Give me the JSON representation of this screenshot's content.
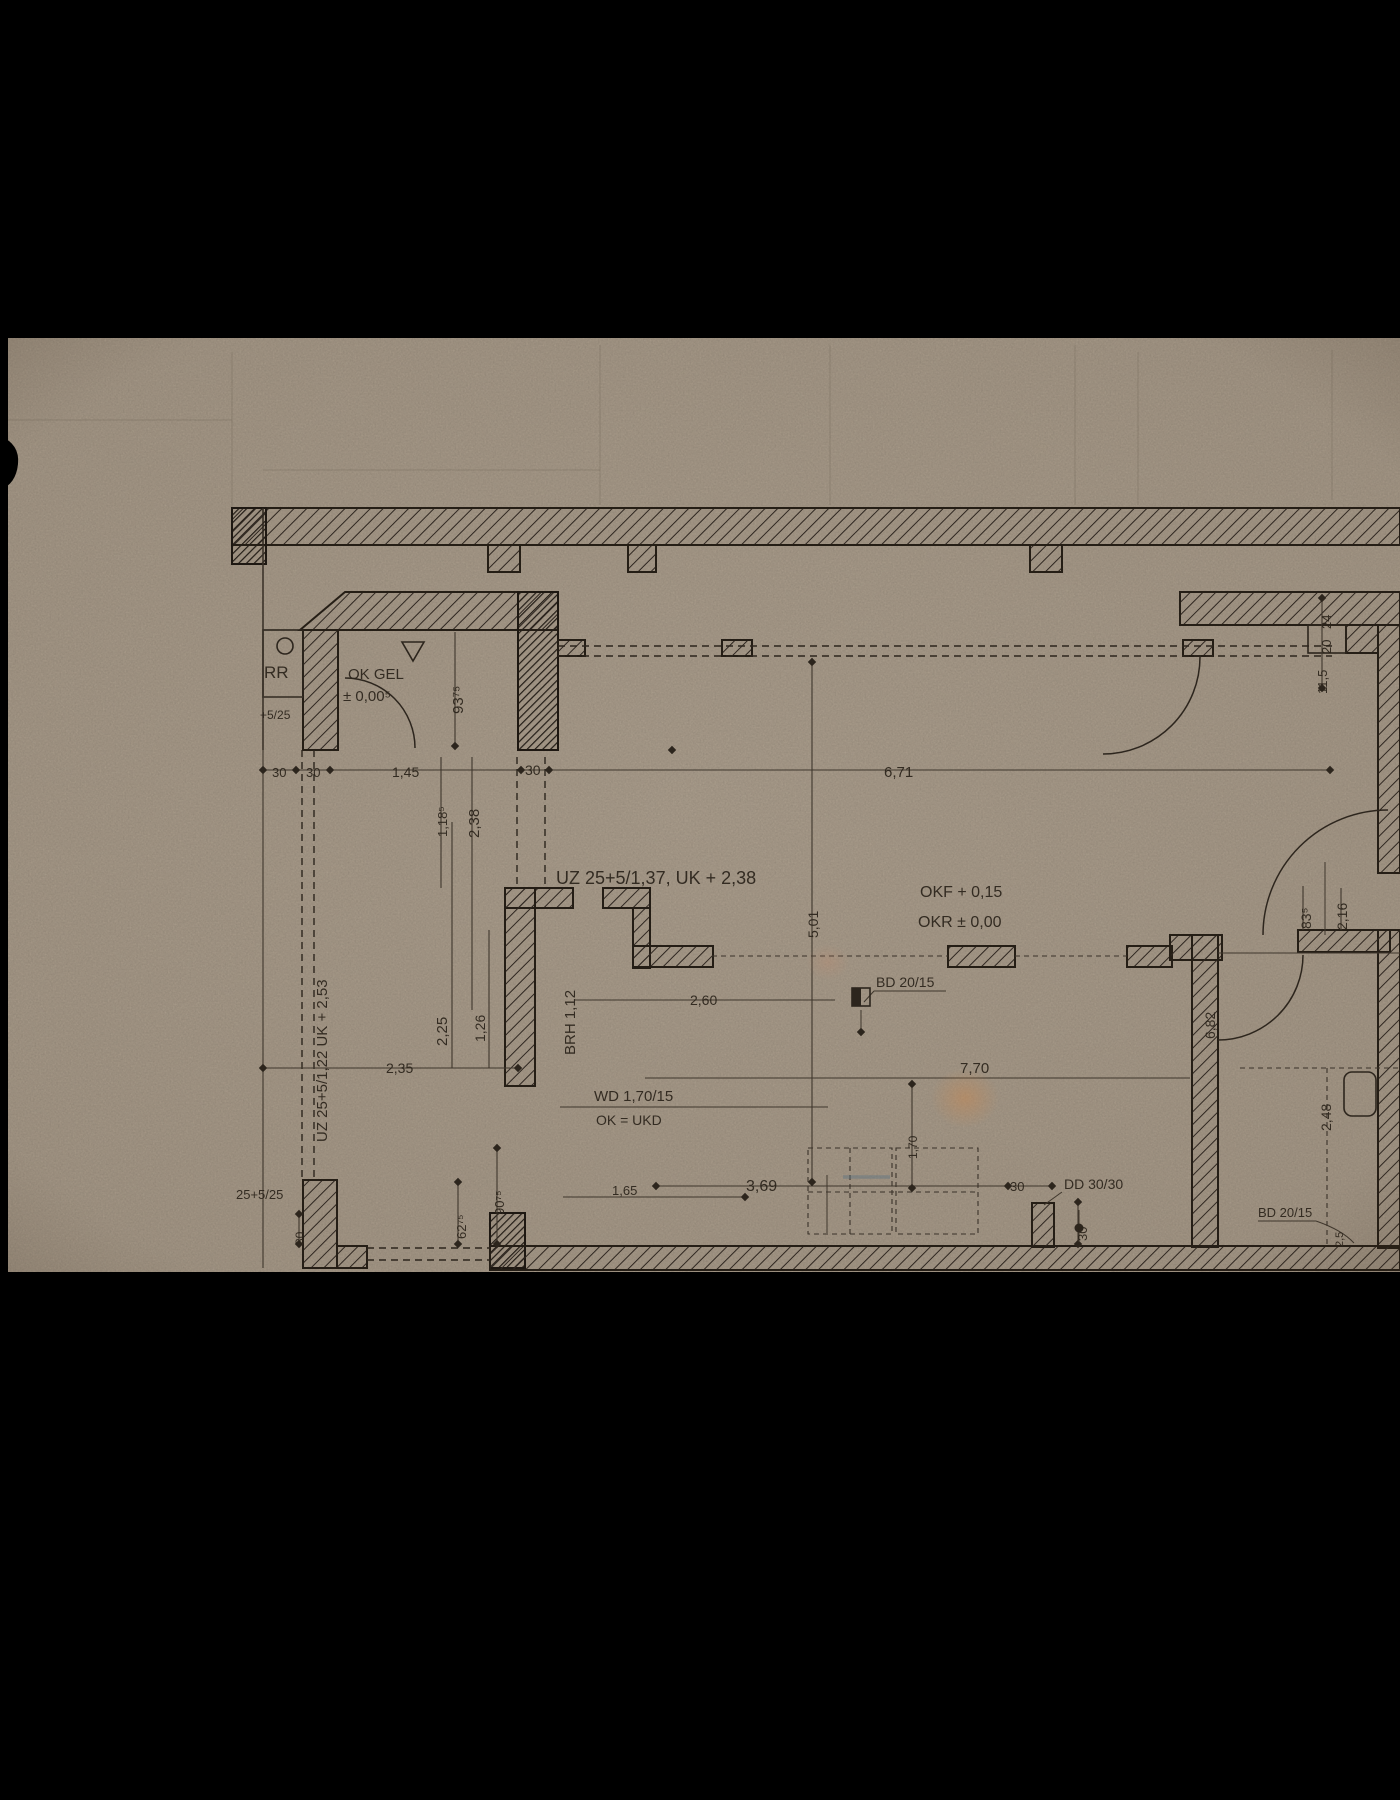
{
  "colors": {
    "letterbox": "#000000",
    "paper": "#b4a694",
    "ink": "#261f18",
    "pencil_guide": "#6b5f52",
    "stain_orange": "#cf8a4f",
    "crayon_blue": "#5d7684"
  },
  "labels": [
    {
      "name": "label-rr",
      "text": "RR",
      "x": 264,
      "y": 678,
      "fs": 17
    },
    {
      "name": "label-ok-gel",
      "text": "OK GEL",
      "x": 348,
      "y": 679,
      "fs": 15
    },
    {
      "name": "label-ok-gel-level",
      "text": "± 0,00⁵",
      "x": 343,
      "y": 701,
      "fs": 15
    },
    {
      "name": "dim-93-75",
      "text": "93⁷⁵",
      "x": 463,
      "y": 714,
      "rot": -90,
      "fs": 15
    },
    {
      "name": "note-5-25",
      "text": "+5/25",
      "x": 260,
      "y": 719,
      "fs": 12
    },
    {
      "name": "dim-30-left-a",
      "text": "30",
      "x": 272,
      "y": 777,
      "fs": 13
    },
    {
      "name": "dim-30-left-b",
      "text": "30",
      "x": 306,
      "y": 777,
      "fs": 13
    },
    {
      "name": "dim-1-45",
      "text": "1,45",
      "x": 392,
      "y": 777,
      "fs": 14
    },
    {
      "name": "dim-30-pier",
      "text": "30",
      "x": 525,
      "y": 775,
      "fs": 14
    },
    {
      "name": "dim-6-71",
      "text": "6,71",
      "x": 884,
      "y": 777,
      "fs": 15
    },
    {
      "name": "dim-1-18-5",
      "text": "1,18⁵",
      "x": 447,
      "y": 837,
      "rot": -90,
      "fs": 13
    },
    {
      "name": "dim-2-38",
      "text": "2,38",
      "x": 479,
      "y": 838,
      "rot": -90,
      "fs": 15
    },
    {
      "name": "dim-24",
      "text": "24",
      "x": 1331,
      "y": 629,
      "rot": -90,
      "fs": 13
    },
    {
      "name": "dim-20",
      "text": "20",
      "x": 1331,
      "y": 654,
      "rot": -90,
      "fs": 13
    },
    {
      "name": "dim-11-5",
      "text": "11,5",
      "x": 1327,
      "y": 694,
      "rot": -90,
      "fs": 13
    },
    {
      "name": "label-beam-uz-137",
      "text": "UZ 25+5/1,37, UK + 2,38",
      "x": 556,
      "y": 884,
      "fs": 18
    },
    {
      "name": "label-okf",
      "text": "OKF + 0,15",
      "x": 920,
      "y": 897,
      "fs": 16
    },
    {
      "name": "label-okr",
      "text": "OKR ± 0,00",
      "x": 918,
      "y": 927,
      "fs": 16
    },
    {
      "name": "dim-83-5",
      "text": "83⁵",
      "x": 1311,
      "y": 929,
      "rot": -90,
      "fs": 14
    },
    {
      "name": "dim-2-16",
      "text": "2,16",
      "x": 1347,
      "y": 930,
      "rot": -90,
      "fs": 14
    },
    {
      "name": "dim-5-01",
      "text": "5,01",
      "x": 818,
      "y": 938,
      "rot": -90,
      "fs": 14
    },
    {
      "name": "dim-2-60",
      "text": "2,60",
      "x": 690,
      "y": 1005,
      "fs": 14
    },
    {
      "name": "label-bd-20-15-mid",
      "text": "BD 20/15",
      "x": 876,
      "y": 987,
      "fs": 14
    },
    {
      "name": "dim-brh-1-12",
      "text": "BRH 1,12",
      "x": 575,
      "y": 1055,
      "rot": -90,
      "fs": 15
    },
    {
      "name": "dim-2-25",
      "text": "2,25",
      "x": 447,
      "y": 1046,
      "rot": -90,
      "fs": 15
    },
    {
      "name": "dim-1-26",
      "text": "1,26",
      "x": 485,
      "y": 1042,
      "rot": -90,
      "fs": 14
    },
    {
      "name": "dim-2-35",
      "text": "2,35",
      "x": 386,
      "y": 1073,
      "fs": 14
    },
    {
      "name": "label-beam-uz-122",
      "text": "UZ 25+5/1,22  UK + 2,53",
      "x": 327,
      "y": 1142,
      "rot": -90,
      "fs": 15
    },
    {
      "name": "label-wd-1-70-15",
      "text": "WD 1,70/15",
      "x": 594,
      "y": 1101,
      "fs": 15
    },
    {
      "name": "label-ok-ukd",
      "text": "OK = UKD",
      "x": 596,
      "y": 1125,
      "fs": 14
    },
    {
      "name": "dim-7-70",
      "text": "7,70",
      "x": 960,
      "y": 1073,
      "fs": 15
    },
    {
      "name": "dim-1-70",
      "text": "1,70",
      "x": 917,
      "y": 1159,
      "rot": -90,
      "fs": 12
    },
    {
      "name": "dim-3-69",
      "text": "3,69",
      "x": 746,
      "y": 1191,
      "fs": 16
    },
    {
      "name": "dim-1-65",
      "text": "1,65",
      "x": 612,
      "y": 1195,
      "fs": 13
    },
    {
      "name": "dim-30-right",
      "text": "30",
      "x": 1010,
      "y": 1191,
      "fs": 13
    },
    {
      "name": "label-dd-30-30",
      "text": "DD 30/30",
      "x": 1064,
      "y": 1189,
      "fs": 14
    },
    {
      "name": "dim-30-bottom",
      "text": "30",
      "x": 1087,
      "y": 1241,
      "rot": -90,
      "fs": 13
    },
    {
      "name": "label-bd-20-15-br",
      "text": "BD 20/15",
      "x": 1258,
      "y": 1217,
      "fs": 13
    },
    {
      "name": "dim-2-5",
      "text": "2,5",
      "x": 1343,
      "y": 1247,
      "rot": -90,
      "fs": 11
    },
    {
      "name": "dim-2-48",
      "text": "2,48",
      "x": 1331,
      "y": 1131,
      "rot": -90,
      "fs": 14
    },
    {
      "name": "dim-6-82",
      "text": "6,82",
      "x": 1215,
      "y": 1039,
      "rot": -90,
      "fs": 14
    },
    {
      "name": "note-25-5-25",
      "text": "25+5/25",
      "x": 236,
      "y": 1199,
      "fs": 13
    },
    {
      "name": "dim-62-75",
      "text": "62⁷⁵",
      "x": 466,
      "y": 1239,
      "rot": -90,
      "fs": 13
    },
    {
      "name": "dim-90-75",
      "text": "90⁷⁵",
      "x": 504,
      "y": 1215,
      "rot": -90,
      "fs": 13
    },
    {
      "name": "dim-30-bl",
      "text": "30",
      "x": 304,
      "y": 1245,
      "rot": -90,
      "fs": 12
    }
  ]
}
